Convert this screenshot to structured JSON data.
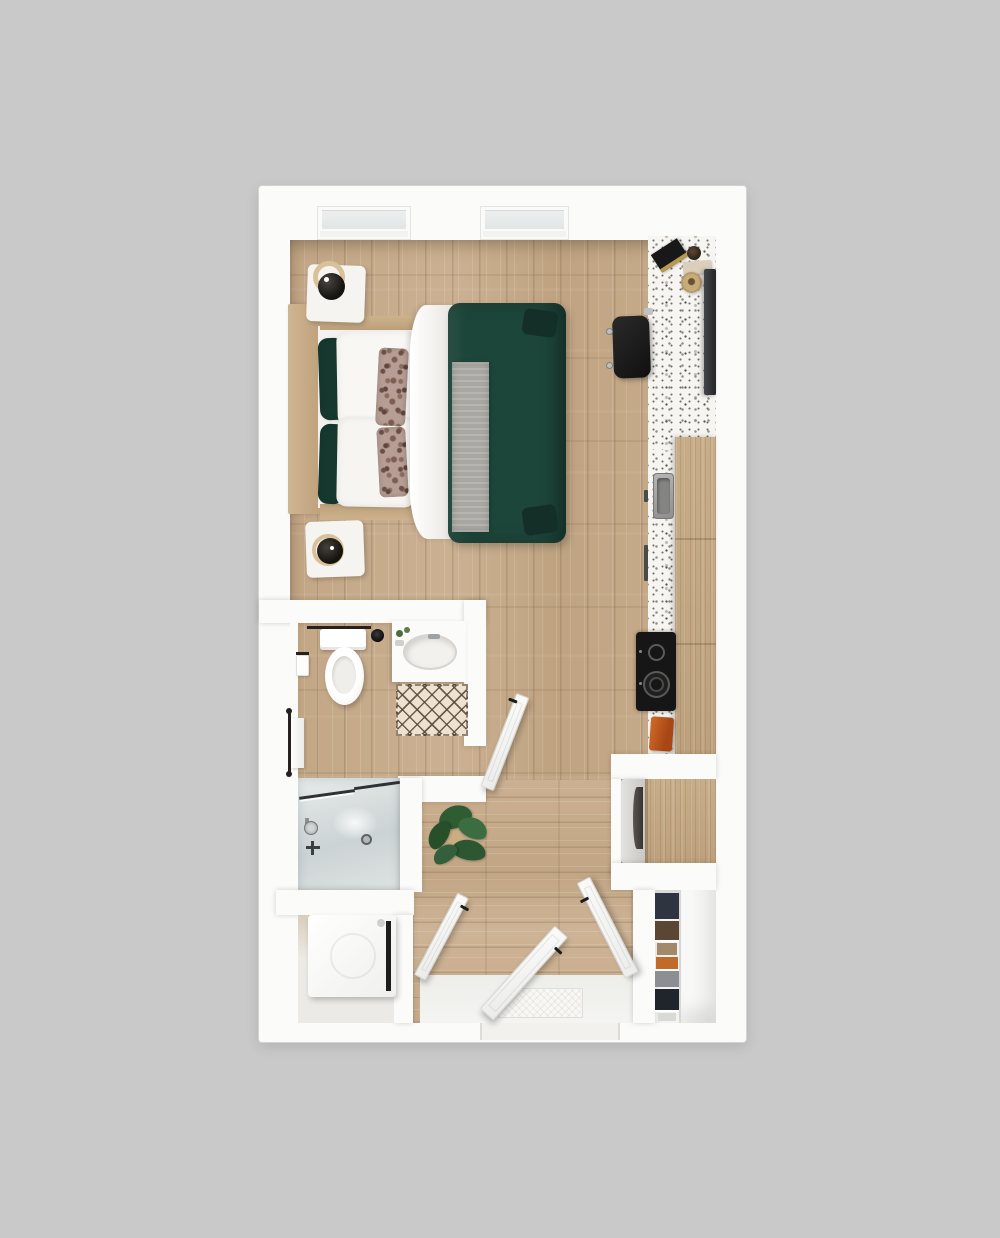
{
  "scene": {
    "type": "3d-floor-plan-top-down-render",
    "subject": "studio-apartment",
    "rooms": [
      "main-living-bedroom",
      "bathroom",
      "shower",
      "laundry-alcove",
      "kitchen-run",
      "entry-hall",
      "closet"
    ],
    "objects": [
      "double-bed-green-duvet",
      "headboard",
      "nightstand-upper",
      "nightstand-lower",
      "table-lamp-upper",
      "table-lamp-lower",
      "desk-chair",
      "wall-tv",
      "terrazzo-counter",
      "counter-decor-books",
      "counter-decor-cup",
      "counter-decor-basket",
      "kitchen-sink",
      "cooktop-two-burner",
      "orange-dish-towel",
      "tall-wood-cabinet",
      "microwave-cabinet",
      "wardrobe-with-clothes",
      "toilet",
      "vanity-sink",
      "diamond-bath-mat",
      "towel-bar",
      "toilet-paper-holder",
      "hand-towel",
      "walk-in-shower",
      "shower-head",
      "floor-drain",
      "washing-machine",
      "potted-plant",
      "entry-door-open",
      "bathroom-door-open",
      "hall-door-open",
      "closet-door-open",
      "window-left",
      "window-right",
      "entry-door-mat"
    ]
  },
  "palette": {
    "bg": "#c9c9c9",
    "wall": "#fbfbfa",
    "wood": "#c6ab8b",
    "cabinet": "#c4a883",
    "terrazzo": "#f6f5f1",
    "duvet": "#1d463a",
    "pillow-green": "#16382e",
    "bedding": "#f3f2ef",
    "floral": "#b69e94",
    "throw": "#a8a7a2",
    "headboard": "#c9ad87",
    "shower-glass": "#dce2e3",
    "appliance": "#f8f8f6",
    "cooktop": "#161616",
    "steel": "#a7a7a5",
    "chair": "#191919",
    "tv": "#303436",
    "towel": "#c2561c",
    "plant": "#2f5c33",
    "mat": "#ece2cf",
    "lattice": "#564436",
    "door": "#f7f7f5",
    "handle": "#1c1c1c",
    "clothes-navy": "#2e3440",
    "clothes-brown": "#5a4632",
    "clothes-orange": "#c26a2a",
    "clothes-gray": "#8b8f94",
    "clothes-dark": "#20242b",
    "shoe": "#d9d9d5"
  }
}
